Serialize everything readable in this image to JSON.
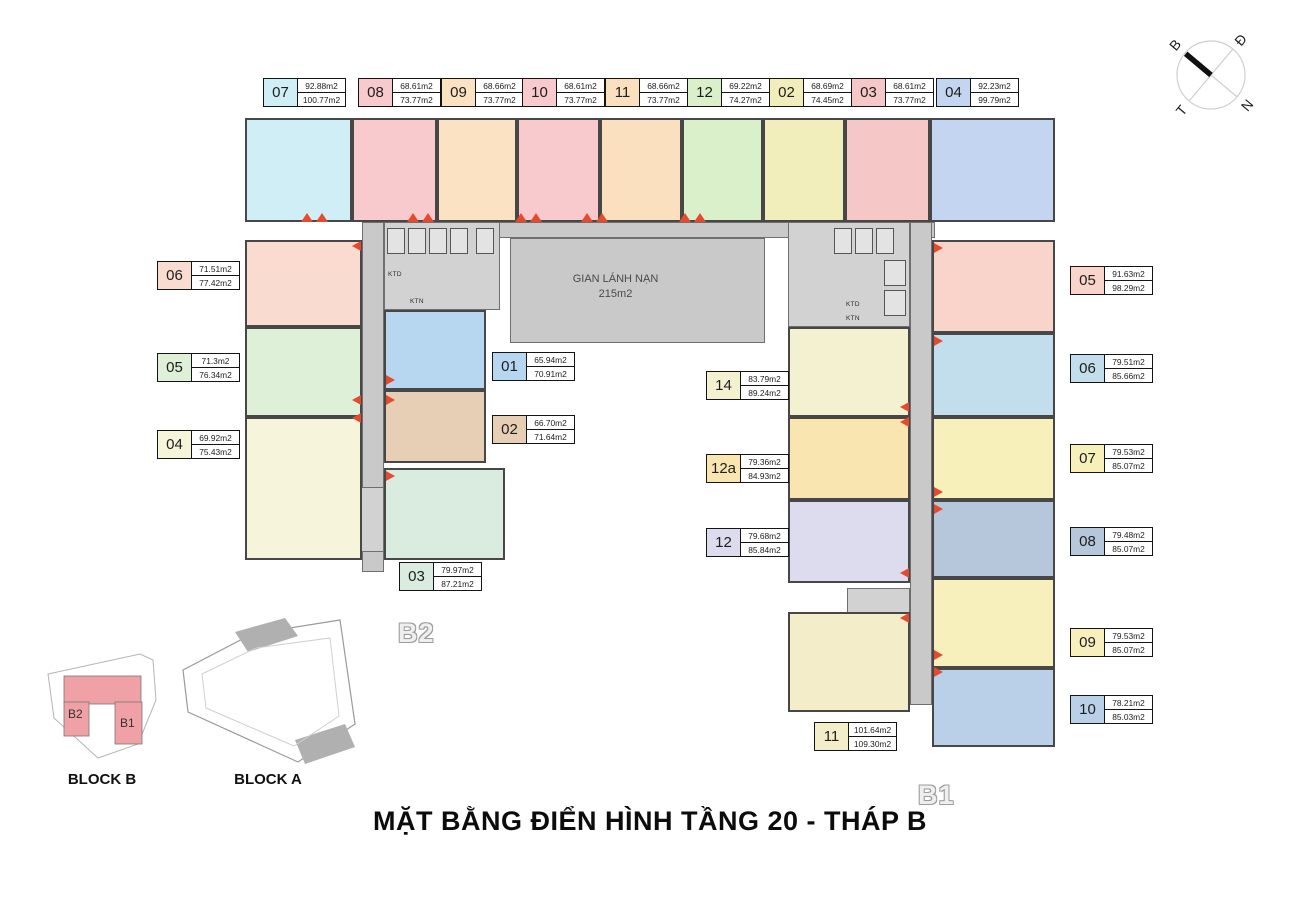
{
  "title": "MẶT BẰNG ĐIỂN HÌNH TẦNG 20 - THÁP B",
  "compass": {
    "n": "B",
    "e": "Đ",
    "s": "N",
    "w": "T"
  },
  "refuge": {
    "line1": "GIAN LÁNH NẠN",
    "line2": "215m2"
  },
  "watermarks": {
    "b2": "B2",
    "b1": "B1"
  },
  "core": {
    "ktd": "KTD",
    "ktn": "KTN"
  },
  "site_map": {
    "block_b": "BLOCK B",
    "block_a": "BLOCK A",
    "b2": "B2",
    "b1": "B1"
  },
  "units": {
    "t07": {
      "id": "07",
      "area1": "92.88m2",
      "area2": "100.77m2",
      "color": "#cfeef5"
    },
    "t08": {
      "id": "08",
      "area1": "68.61m2",
      "area2": "73.77m2",
      "color": "#f8cacd"
    },
    "t09": {
      "id": "09",
      "area1": "68.66m2",
      "area2": "73.77m2",
      "color": "#fae2c3"
    },
    "t10": {
      "id": "10",
      "area1": "68.61m2",
      "area2": "73.77m2",
      "color": "#f8cacd"
    },
    "t11": {
      "id": "11",
      "area1": "68.66m2",
      "area2": "73.77m2",
      "color": "#fbe0c0"
    },
    "t12": {
      "id": "12",
      "area1": "69.22m2",
      "area2": "74.27m2",
      "color": "#daf0ca"
    },
    "t02": {
      "id": "02",
      "area1": "68.69m2",
      "area2": "74.45m2",
      "color": "#f1eebb"
    },
    "t03": {
      "id": "03",
      "area1": "68.61m2",
      "area2": "73.77m2",
      "color": "#f6c7c7"
    },
    "t04": {
      "id": "04",
      "area1": "92.23m2",
      "area2": "99.79m2",
      "color": "#c4d5f1"
    },
    "l06": {
      "id": "06",
      "area1": "71.51m2",
      "area2": "77.42m2",
      "color": "#fadbd0"
    },
    "l05": {
      "id": "05",
      "area1": "71.3m2",
      "area2": "76.34m2",
      "color": "#def0d7"
    },
    "l04": {
      "id": "04",
      "area1": "69.92m2",
      "area2": "75.43m2",
      "color": "#f6f5db"
    },
    "il01": {
      "id": "01",
      "area1": "65.94m2",
      "area2": "70.91m2",
      "color": "#b7d6ef"
    },
    "il02": {
      "id": "02",
      "area1": "66.70m2",
      "area2": "71.64m2",
      "color": "#e6cfb4"
    },
    "il03": {
      "id": "03",
      "area1": "79.97m2",
      "area2": "87.21m2",
      "color": "#d9ecdf"
    },
    "ir14": {
      "id": "14",
      "area1": "83.79m2",
      "area2": "89.24m2",
      "color": "#f4f1d0"
    },
    "ir12a": {
      "id": "12a",
      "area1": "79.36m2",
      "area2": "84.93m2",
      "color": "#f8e5b0"
    },
    "ir12": {
      "id": "12",
      "area1": "79.68m2",
      "area2": "85.84m2",
      "color": "#dddcee"
    },
    "ir11": {
      "id": "11",
      "area1": "101.64m2",
      "area2": "109.30m2",
      "color": "#f4edca"
    },
    "r05": {
      "id": "05",
      "area1": "91.63m2",
      "area2": "98.29m2",
      "color": "#f9d4ca"
    },
    "r06": {
      "id": "06",
      "area1": "79.51m2",
      "area2": "85.66m2",
      "color": "#c2ddeb"
    },
    "r07": {
      "id": "07",
      "area1": "79.53m2",
      "area2": "85.07m2",
      "color": "#f7f0bb"
    },
    "r08": {
      "id": "08",
      "area1": "79.48m2",
      "area2": "85.07m2",
      "color": "#b6c7dc"
    },
    "r09": {
      "id": "09",
      "area1": "79.53m2",
      "area2": "85.07m2",
      "color": "#f7f0bd"
    },
    "r10": {
      "id": "10",
      "area1": "78.21m2",
      "area2": "85.03m2",
      "color": "#bad0e8"
    }
  }
}
